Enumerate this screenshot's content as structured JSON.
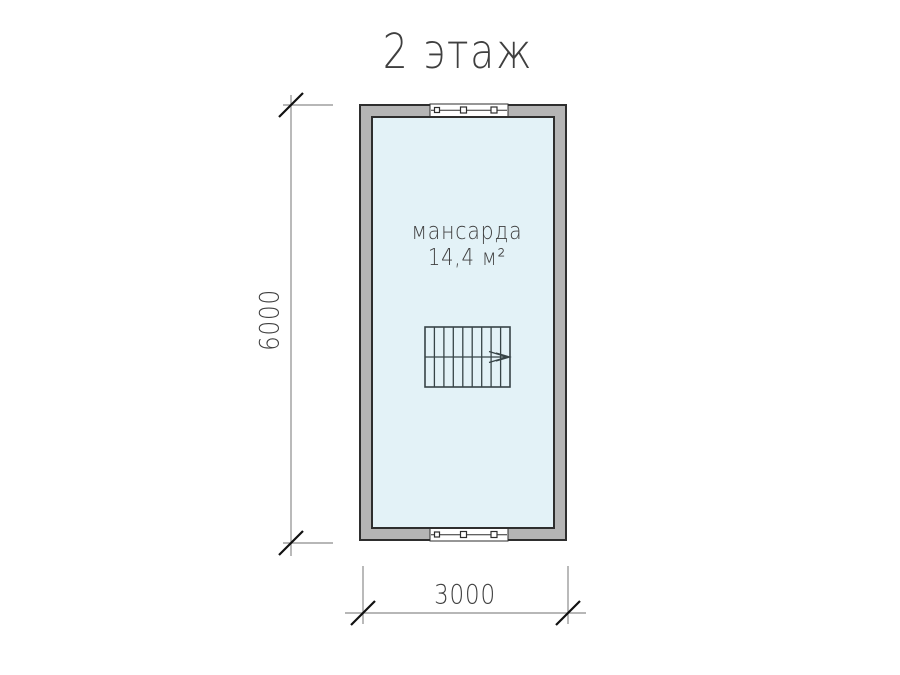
{
  "title": "2 этаж",
  "room": {
    "name": "мансарда",
    "area": "14,4 м²"
  },
  "dimensions": {
    "height": "6000",
    "width": "3000"
  },
  "colors": {
    "wall": "#b5b5b5",
    "outline": "#2e2e2e",
    "interior": "#e3f2f7",
    "line-gray": "#8c8c8c",
    "line-dark": "#111111",
    "stair": "#374447",
    "window-fill": "#ffffff",
    "text": "#3f3f3f"
  }
}
